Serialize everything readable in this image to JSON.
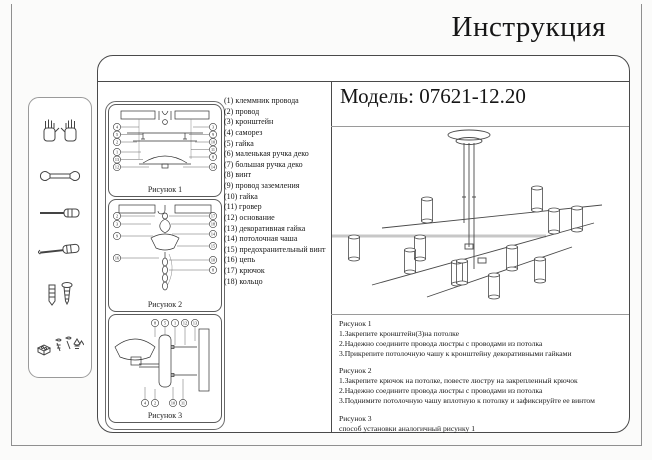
{
  "page": {
    "title": "Инструкция"
  },
  "model": {
    "label": "Модель: 07621-12.20"
  },
  "sidebar": {
    "icons": [
      "gloves-icon",
      "wrench-icon",
      "flat-screwdriver-icon",
      "phillips-screwdriver-icon",
      "dowel-and-screw-icon",
      "fasteners-icon"
    ]
  },
  "figures": [
    {
      "caption": "Рисунок 1",
      "callouts_left": [
        "4",
        "5",
        "2",
        "1",
        "13",
        "12"
      ],
      "callouts_right": [
        "3",
        "9",
        "10",
        "11",
        "8",
        "14"
      ]
    },
    {
      "caption": "Рисунок 2",
      "callouts_left": [
        "2",
        "3",
        "9",
        "16"
      ],
      "callouts_right": [
        "17",
        "18",
        "14",
        "15",
        "10",
        "8"
      ]
    },
    {
      "caption": "Рисунок 3",
      "callouts_top": [
        "8",
        "5",
        "1",
        "12",
        "13"
      ],
      "callouts_bottom": [
        "4",
        "2",
        "10",
        "11"
      ]
    }
  ],
  "parts": [
    "(1) клеммник провода",
    "(2) провод",
    "(3) кронштейн",
    "(4) саморез",
    "(5) гайка",
    "(6) маленькая ручка деко",
    "(7) большая ручка деко",
    "(8) винт",
    "(9) провод заземления",
    "(10) гайка",
    "(11) гровер",
    "(12) основание",
    "(13) декоративная гайка",
    "(14) потолочная чаша",
    "(15) предохранительный винт",
    "(16) цепь",
    "(17) крючок",
    "(18) кольцо"
  ],
  "instructions": [
    {
      "title": "Рисунок 1",
      "steps": [
        "1.Закрепите кронштейн(3)на потолке",
        "2.Надежно соедините провода люстры с проводами из потолка",
        "3.Прикрепите потолочную чашу к кронштейну декоративными гайками"
      ]
    },
    {
      "title": "Рисунок 2",
      "steps": [
        "1.Закрепите крючок на потолке, повесте люстру на закрепленный крючок",
        "2.Надежно соедините провода люстры с проводами из потолка",
        "3.Поднимите потолочную чашу вплотную к потолку и зафиксируйте ее винтом"
      ]
    },
    {
      "title": "Рисунок 3",
      "steps": [
        "способ установки аналогичный рисунку 1"
      ]
    }
  ]
}
